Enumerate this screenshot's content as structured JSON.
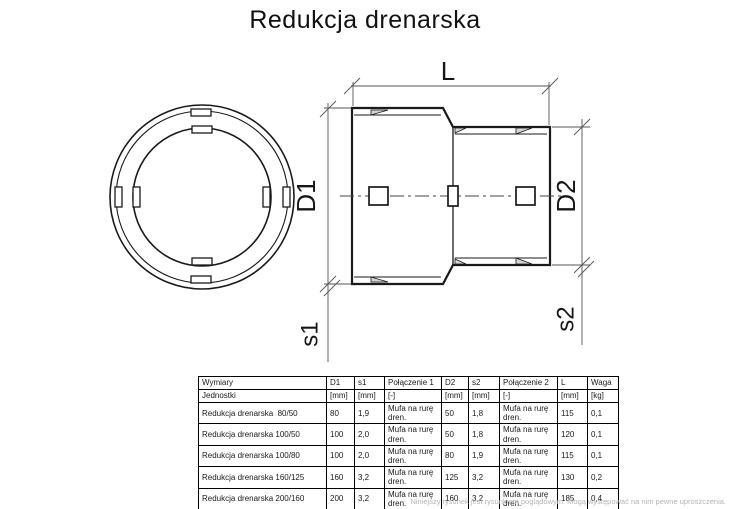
{
  "page": {
    "title": "Redukcja drenarska",
    "footer_note": "Niniejszy rysunek jest rysunkiem poglądowym. Mogą występować na nim pewne uproszczenia."
  },
  "colors": {
    "outline": "#1a1a1a",
    "dimension_lines": "#555555",
    "hatch_fill": "#d4d4d4",
    "footer_text": "#b5b5b5"
  },
  "drawing": {
    "labels": {
      "length": "L",
      "d1": "D1",
      "d2": "D2",
      "s1": "s1",
      "s2": "s2"
    }
  },
  "table": {
    "headers": [
      "Wymiary",
      "D1",
      "s1",
      "Połączenie 1",
      "D2",
      "s2",
      "Połączenie 2",
      "L",
      "Waga"
    ],
    "units": [
      "Jednostki",
      "[mm]",
      "[mm]",
      "[-]",
      "[mm]",
      "[mm]",
      "[-]",
      "[mm]",
      "[kg]"
    ],
    "rows": [
      [
        "Redukcja drenarska  80/50",
        "80",
        "1,9",
        "Mufa na rurę dren.",
        "50",
        "1,8",
        "Mufa na rurę dren.",
        "115",
        "0,1"
      ],
      [
        "Redukcja drenarska 100/50",
        "100",
        "2,0",
        "Mufa na rurę dren.",
        "50",
        "1,8",
        "Mufa na rurę dren.",
        "120",
        "0,1"
      ],
      [
        "Redukcja drenarska 100/80",
        "100",
        "2,0",
        "Mufa na rurę dren.",
        "80",
        "1,9",
        "Mufa na rurę dren.",
        "115",
        "0,1"
      ],
      [
        "Redukcja drenarska 160/125",
        "160",
        "3,2",
        "Mufa na rurę dren.",
        "125",
        "3,2",
        "Mufa na rurę dren.",
        "130",
        "0,2"
      ],
      [
        "Redukcja drenarska 200/160",
        "200",
        "3,2",
        "Mufa na rurę dren.",
        "160",
        "3,2",
        "Mufa na rurę dren.",
        "185",
        "0,4"
      ]
    ]
  }
}
